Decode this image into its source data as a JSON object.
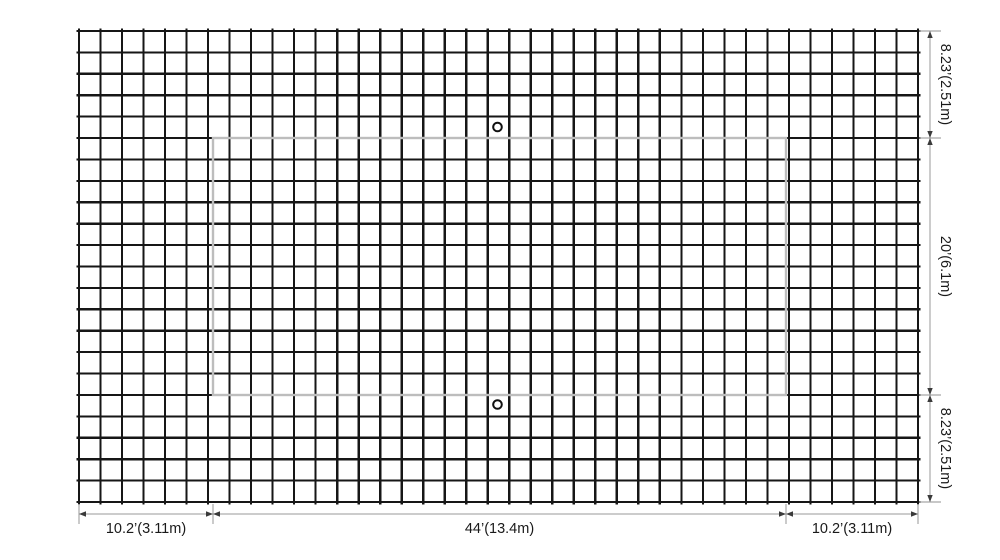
{
  "diagram": {
    "title": "net-court-dimension-drawing",
    "dimensions": {
      "bottom": [
        {
          "label": "10.2’(3.11m)",
          "feet": "10.2’",
          "meters": "3.11m"
        },
        {
          "label": "44’(13.4m)",
          "feet": "44’",
          "meters": "13.4m"
        },
        {
          "label": "10.2’(3.11m)",
          "feet": "10.2’",
          "meters": "3.11m"
        }
      ],
      "right": [
        {
          "label": "8.23’(2.51m)",
          "feet": "8.23’",
          "meters": "2.51m"
        },
        {
          "label": "20’(6.1m)",
          "feet": "20’",
          "meters": "6.1m"
        },
        {
          "label": "8.23’(2.51m)",
          "feet": "8.23’",
          "meters": "2.51m"
        }
      ]
    },
    "colors": {
      "background": "#ffffff",
      "mesh": "#161616",
      "court_line": "#bdbdbd",
      "post_stroke": "#111111",
      "post_fill": "#ffffff",
      "dim_line": "#9a9a9a",
      "ext_line": "#a8a8a8",
      "arrow": "#3a3a3a",
      "text": "#1a1a1a"
    },
    "layout": {
      "canvas": {
        "w": 1000,
        "h": 560
      },
      "grid": {
        "x0": 79,
        "y0": 31,
        "x1": 918,
        "y1": 502,
        "cols": 39,
        "rows": 22,
        "overshoot": 2.5,
        "stroke_w": 2.2
      },
      "court": {
        "x": 213,
        "y": 138,
        "w": 573,
        "h": 257,
        "stroke_w": 2.4
      },
      "posts": [
        {
          "cx": 497.5,
          "cy": 127,
          "r": 4.3,
          "stroke_w": 2
        },
        {
          "cx": 497.5,
          "cy": 404.5,
          "r": 4.3,
          "stroke_w": 2
        }
      ],
      "dim_bottom": {
        "y": 514,
        "label_y": 533,
        "bounds": [
          79,
          213,
          786,
          918
        ],
        "ext_top": 504,
        "ext_bot": 524,
        "font_size": 14.5
      },
      "dim_right": {
        "x": 930,
        "label_x": 941,
        "bounds": [
          31,
          138,
          395,
          502
        ],
        "ext_left": 919,
        "ext_right": 941,
        "font_size": 14.5
      },
      "arrow": {
        "len": 7,
        "half_w": 2.7
      }
    }
  }
}
